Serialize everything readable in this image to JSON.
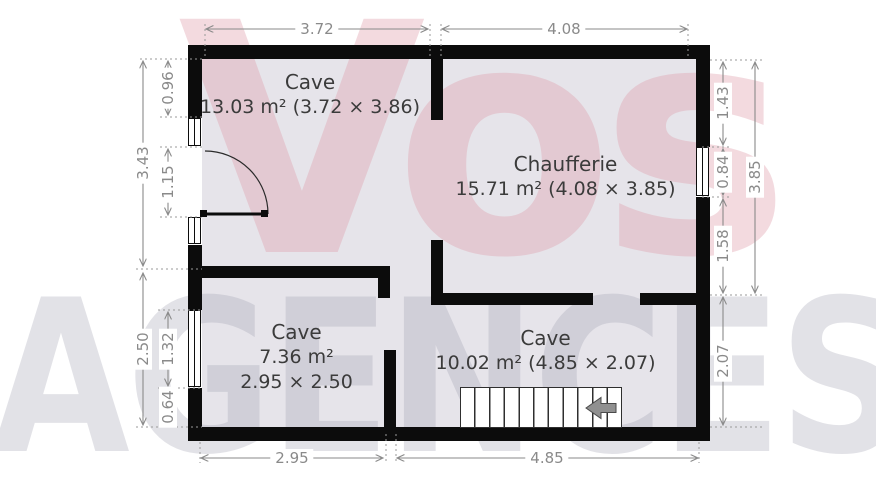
{
  "watermark": {
    "brand_top": "Vos",
    "brand_bottom": "AGENCES"
  },
  "rooms": {
    "cave_top": {
      "name": "Cave",
      "details": "13.03 m² (3.72 × 3.86)"
    },
    "chaufferie": {
      "name": "Chaufferie",
      "details": "15.71 m² (4.08 × 3.85)"
    },
    "cave_left": {
      "name": "Cave",
      "area": "7.36 m²",
      "size": "2.95 × 2.50"
    },
    "cave_bottom": {
      "name": "Cave",
      "details": "10.02 m² (4.85 × 2.07)"
    }
  },
  "dims": {
    "top_left": "3.72",
    "top_right": "4.08",
    "bottom_left": "2.95",
    "bottom_right": "4.85",
    "left_outer_top": "3.43",
    "left_outer_bottom": "2.50",
    "left_inner_1": "0.96",
    "left_inner_2": "1.15",
    "left_inner_3": "1.32",
    "left_inner_4": "0.64",
    "right_inner_1": "1.43",
    "right_inner_2": "0.84",
    "right_inner_3": "1.58",
    "right_inner_4": "2.07",
    "right_outer": "3.85"
  },
  "colors": {
    "wall": "#0c0c0c",
    "floor": "#e8e6ec",
    "dimension": "#8a8a8a",
    "room_text": "#3b3b3b",
    "watermark_pink": "#e09eac",
    "watermark_gray": "#a0a0af"
  }
}
